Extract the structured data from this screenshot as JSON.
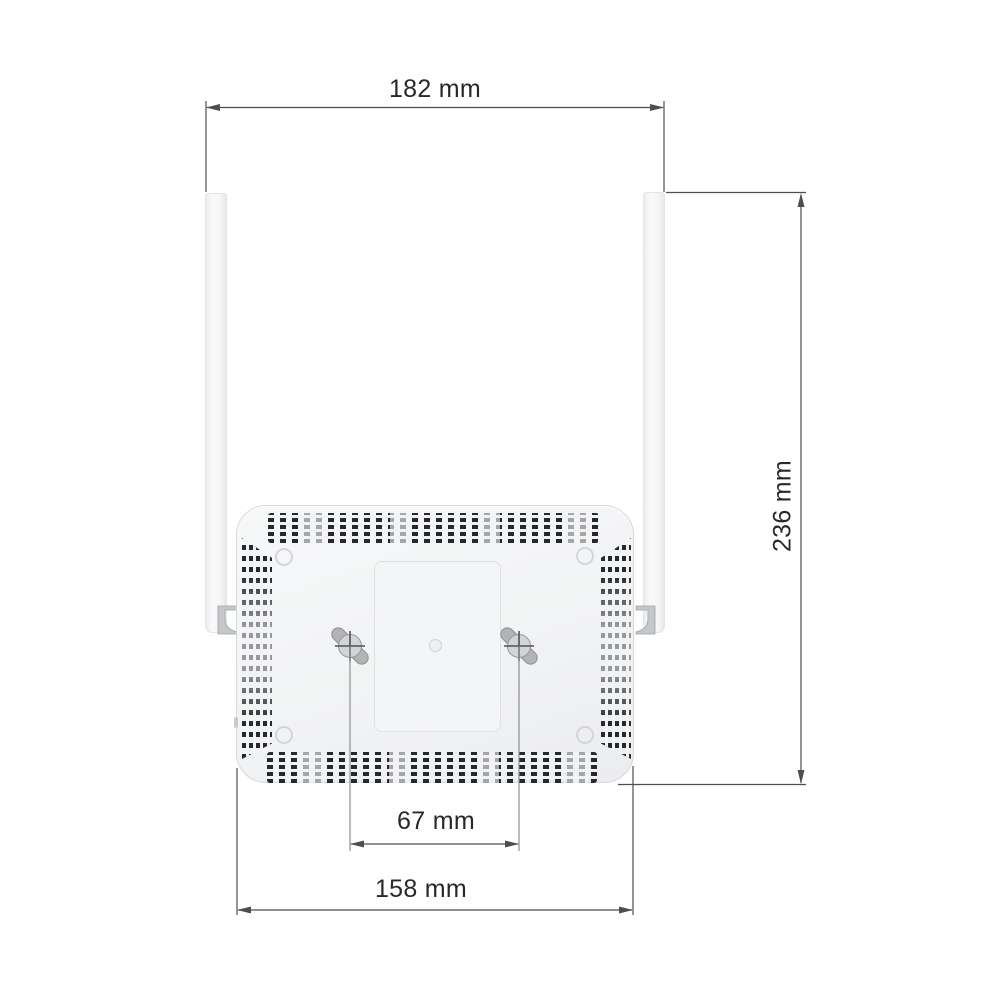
{
  "labels": {
    "overall_width": "182 mm",
    "overall_height": "236 mm",
    "mount_hole_spacing": "67 mm",
    "body_width": "158 mm"
  },
  "colors": {
    "background": "#ffffff",
    "dimension_line": "#4c4e50",
    "screw_guide_line": "#8c8e90",
    "label_text": "#28282a",
    "device_body": "#f2f3f4",
    "device_outline": "#d7d8da",
    "vent_dash_dark": "#26282b",
    "panel_border": "#e0e1e3",
    "metal_gray": "#c5c8ca"
  }
}
